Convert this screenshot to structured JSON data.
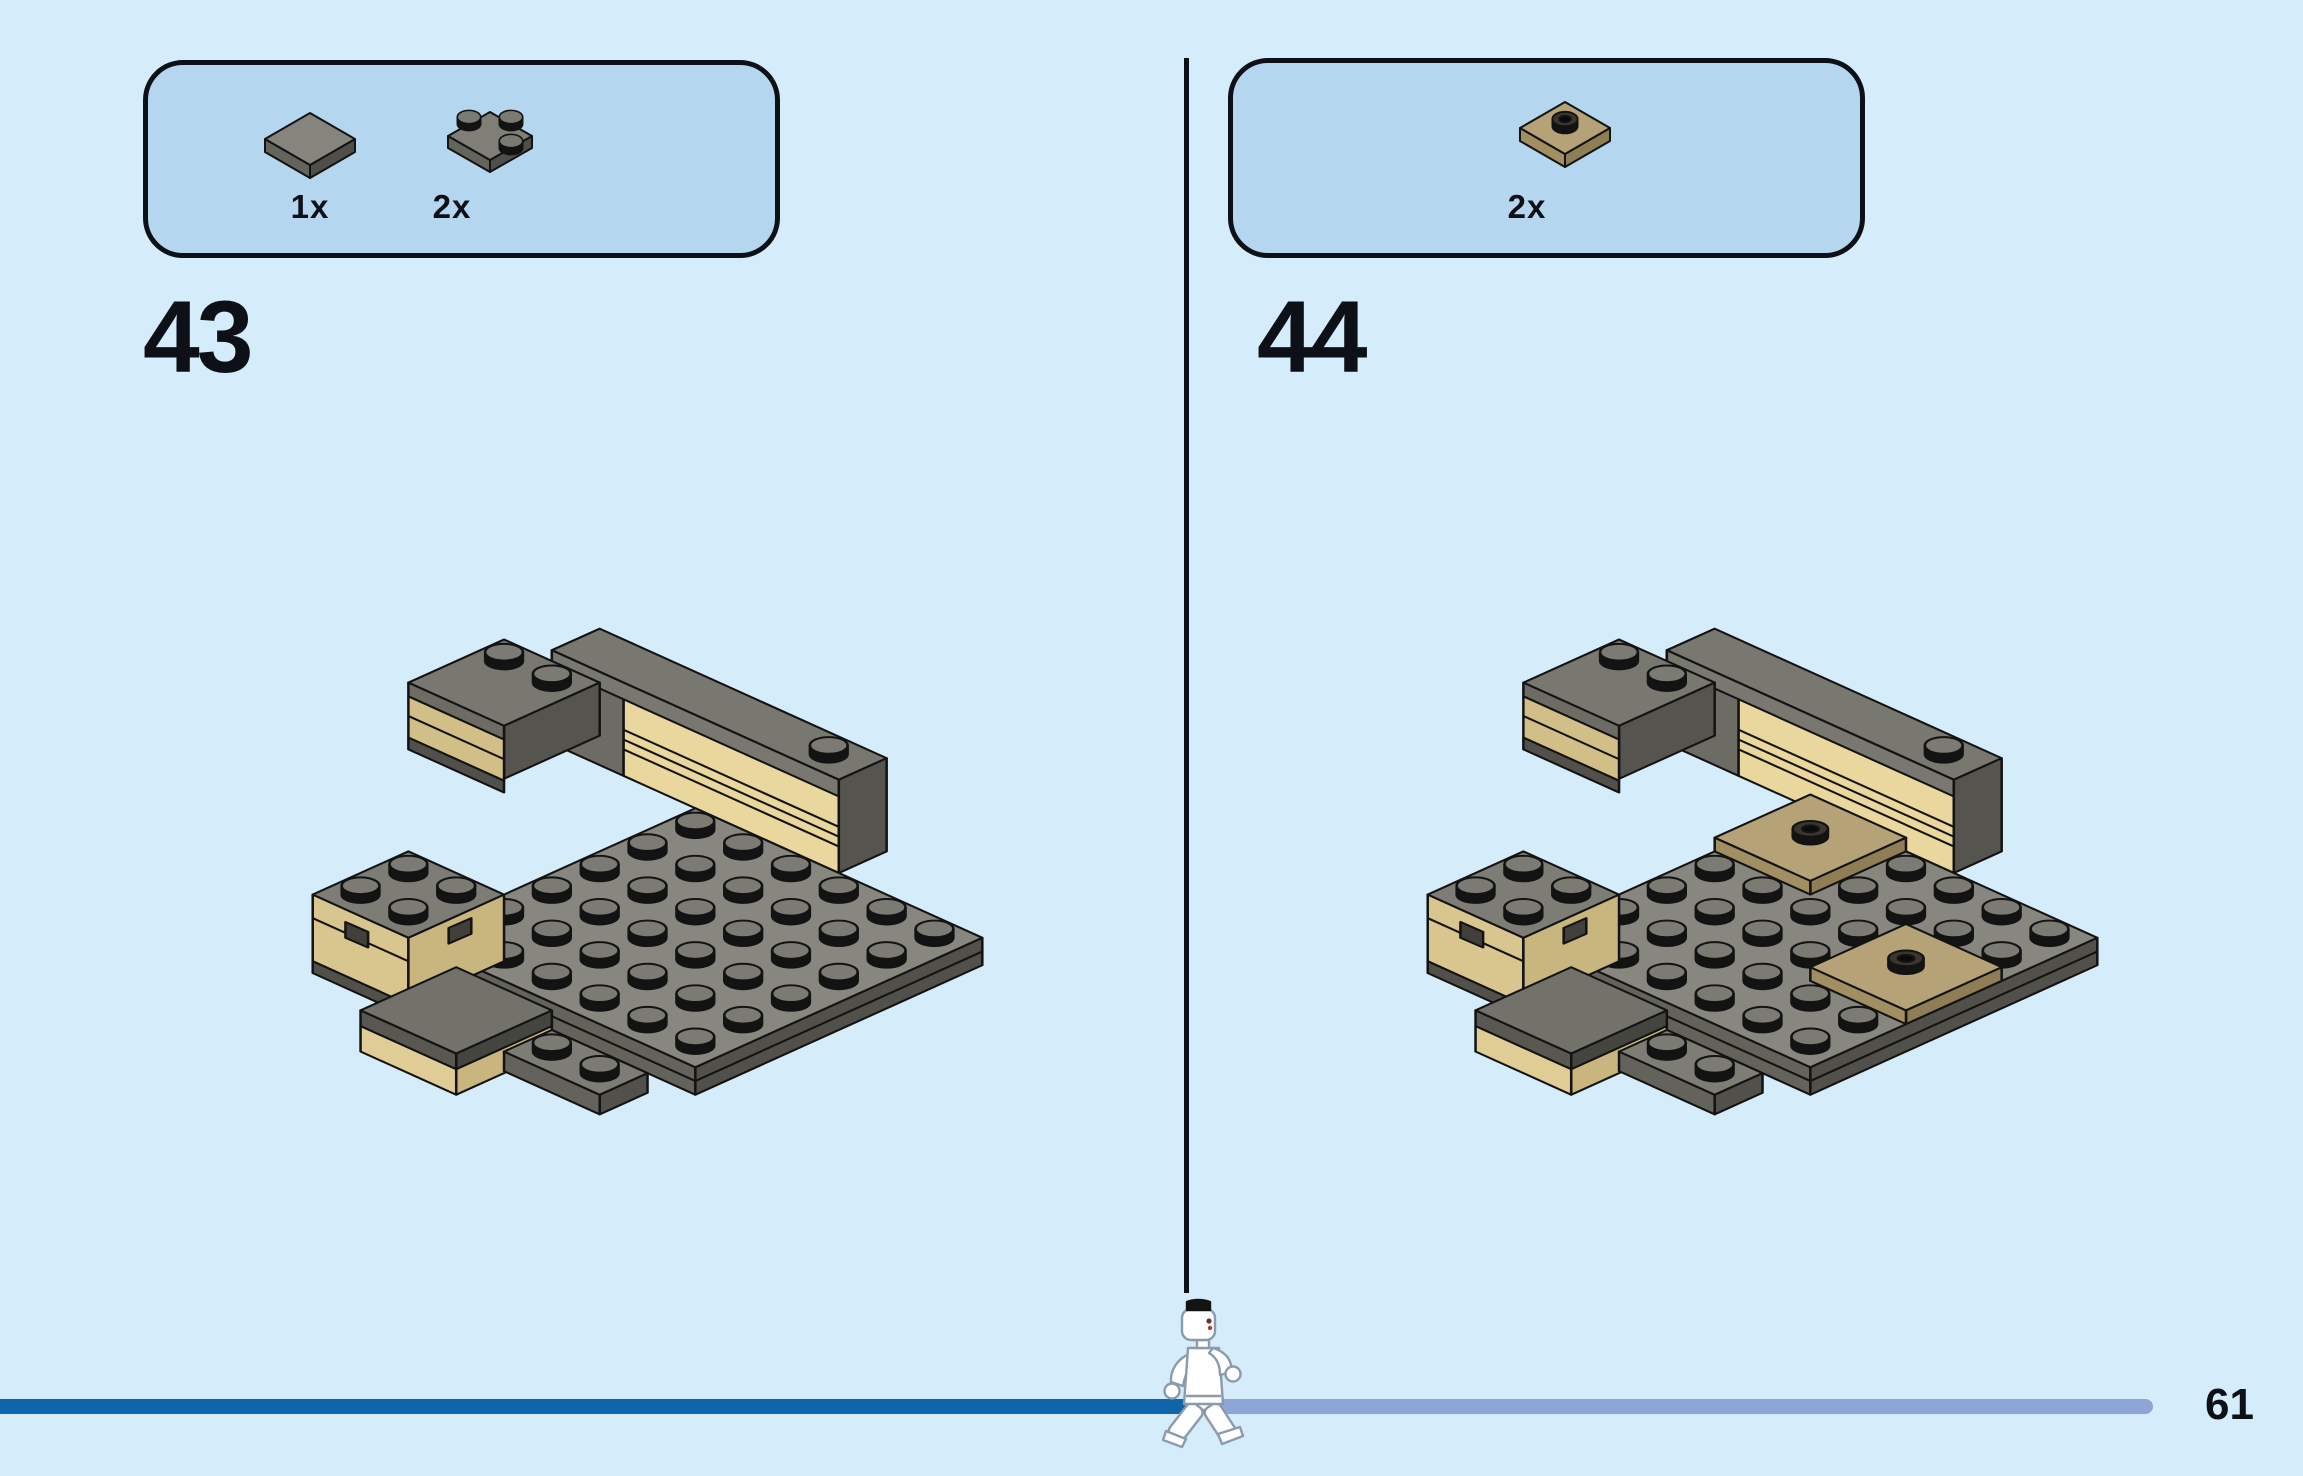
{
  "page": {
    "number": "61"
  },
  "steps": [
    {
      "number": "43",
      "parts": [
        {
          "qty": "1x",
          "name": "tile-2x2-dark-gray"
        },
        {
          "qty": "2x",
          "name": "corner-plate-2x2-dark-gray"
        }
      ]
    },
    {
      "number": "44",
      "parts": [
        {
          "qty": "2x",
          "name": "jumper-plate-2x2-dark-tan"
        }
      ]
    }
  ],
  "progress": {
    "filled_color": "#0f65a9",
    "remaining_color": "#8da5d7"
  },
  "colors": {
    "background": "#d5ecfa",
    "panel_fill": "#b4d6ee",
    "outline": "#0d1117",
    "gray_top": "#87867f",
    "gray_side_mid": "#63625b",
    "gray_side_dark": "#51504a",
    "stud_top": "#7b7a73",
    "tan_bright": "#e9d79d",
    "tan_mid": "#d2bf87",
    "tan_plate_top": "#b5a277",
    "tan_plate_side": "#8f7d55"
  }
}
